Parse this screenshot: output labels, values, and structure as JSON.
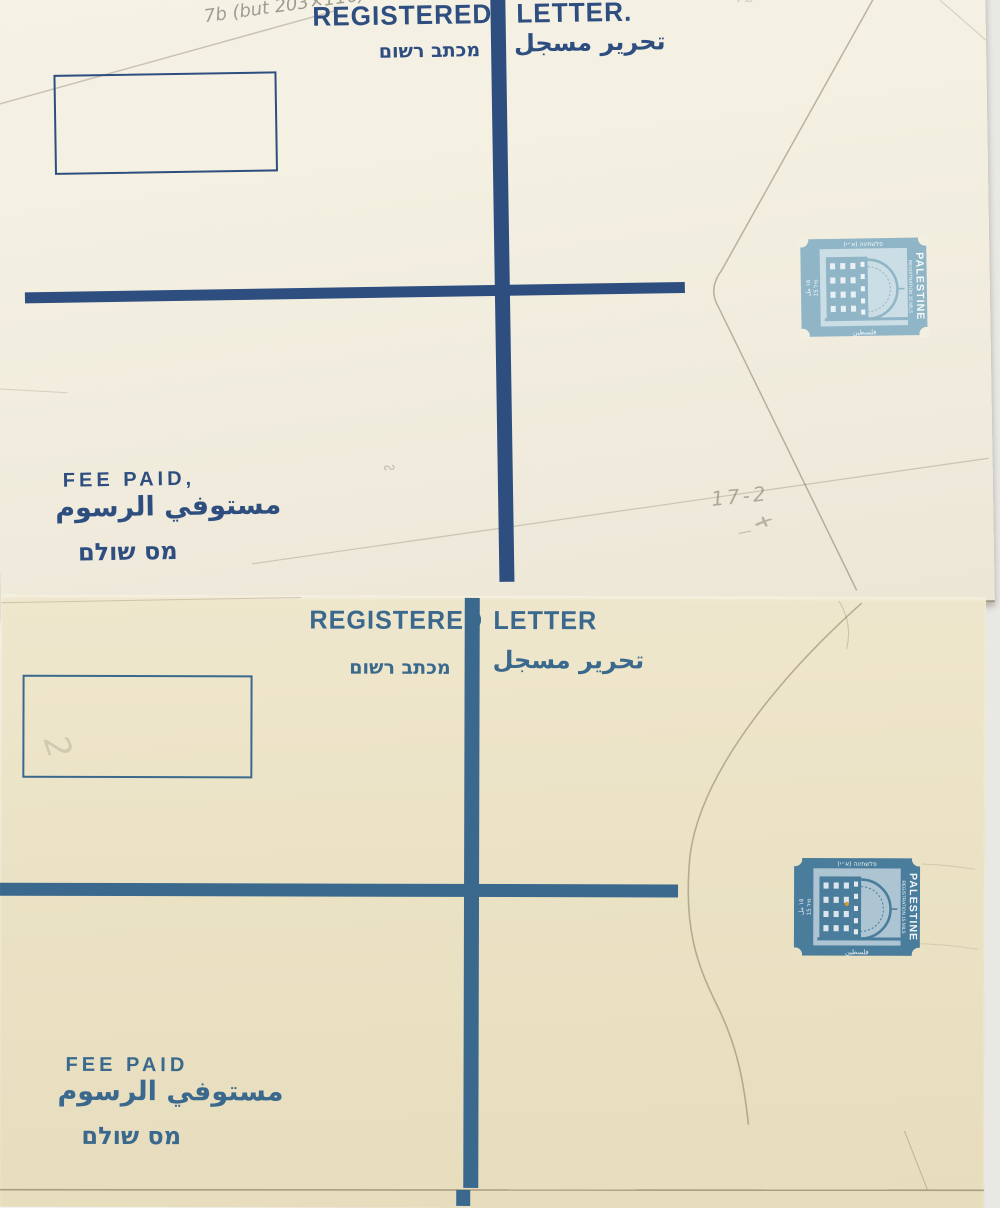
{
  "background": {
    "color": "#f2f1ee",
    "right_strip_color": "#e9e8e5"
  },
  "envelope_top": {
    "paper_color": "#f3efe1",
    "ink_color": "#2e4e80",
    "header": {
      "word_left": "REGISTERED",
      "word_right": "LETTER."
    },
    "subheader": {
      "hebrew": "מכתב רשום",
      "arabic": "تحرير مسجل"
    },
    "fee_paid": {
      "english": "FEE PAID,",
      "arabic": "مستوفي الرسوم",
      "hebrew": "מס שולם"
    },
    "stamp": {
      "color": "#8fb5c6",
      "country": "PALESTINE",
      "service": "REGISTRATION 15 MILS",
      "top_hebrew": "פלשתינה (א״י)",
      "bottom_arabic": "فلسطين",
      "left_value_arabic": "١٥ مل",
      "left_value_hebrew": "15 מיל"
    },
    "pencil": {
      "top_left": "7b (but 203×116)",
      "top_right": "7b",
      "mid_right": "17-2",
      "mid_right_mark": "✗",
      "mid_right_dash": "—",
      "center_squiggle": "∾"
    }
  },
  "envelope_bottom": {
    "paper_color": "#ebe2c5",
    "ink_color": "#3a698d",
    "header": {
      "word_left": "REGISTERED",
      "word_right": "LETTER"
    },
    "subheader": {
      "hebrew": "מכתב רשום",
      "arabic": "تحرير مسجل"
    },
    "fee_paid": {
      "english": "FEE PAID",
      "arabic": "مستوفي الرسوم",
      "hebrew": "מס שולם"
    },
    "stamp": {
      "color": "#4a7c9b",
      "country": "PALESTINE",
      "service": "REGISTRATION 15 MILS",
      "top_hebrew": "פלשתינה (א״י)",
      "bottom_arabic": "فلسطين",
      "left_value_arabic": "١٥ مل",
      "left_value_hebrew": "15 מיל"
    },
    "pencil": {
      "inside_box": "2"
    }
  }
}
